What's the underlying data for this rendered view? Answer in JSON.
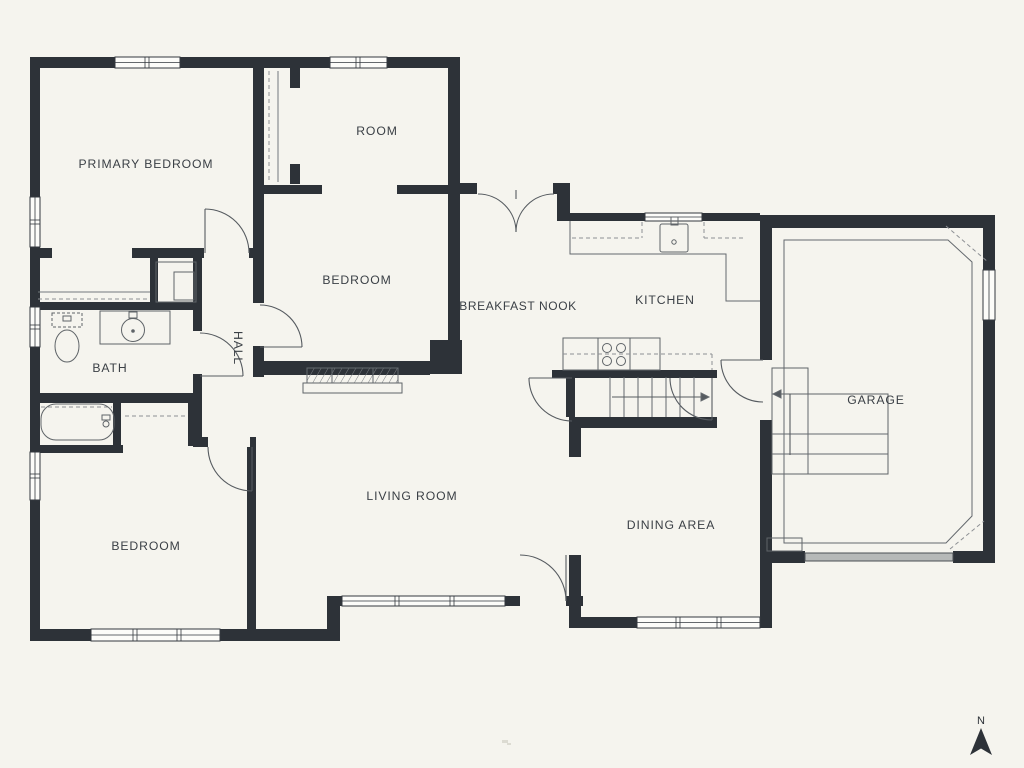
{
  "rooms": {
    "primary_bedroom": {
      "label": "PRIMARY BEDROOM"
    },
    "room": {
      "label": "ROOM"
    },
    "bedroom_middle": {
      "label": "BEDROOM"
    },
    "breakfast_nook": {
      "label": "BREAKFAST NOOK"
    },
    "kitchen": {
      "label": "KITCHEN"
    },
    "garage": {
      "label": "GARAGE"
    },
    "hall": {
      "label": "HALL"
    },
    "bath": {
      "label": "BATH"
    },
    "living_room": {
      "label": "LIVING ROOM"
    },
    "dining_area": {
      "label": "DINING AREA"
    },
    "bedroom_lower": {
      "label": "BEDROOM"
    }
  },
  "compass": {
    "label": "N"
  },
  "colors": {
    "background": "#f5f4ee",
    "wall": "#2d3238",
    "thin_line": "#64696e",
    "label_text": "#3b4046",
    "garage_door": "#b6b9b8"
  },
  "fixtures": [
    "bathtub",
    "toilet",
    "bathroom-sink",
    "kitchen-sink",
    "stove",
    "fireplace",
    "stairs",
    "garage-steps",
    "closet-rods",
    "north-arrow"
  ]
}
